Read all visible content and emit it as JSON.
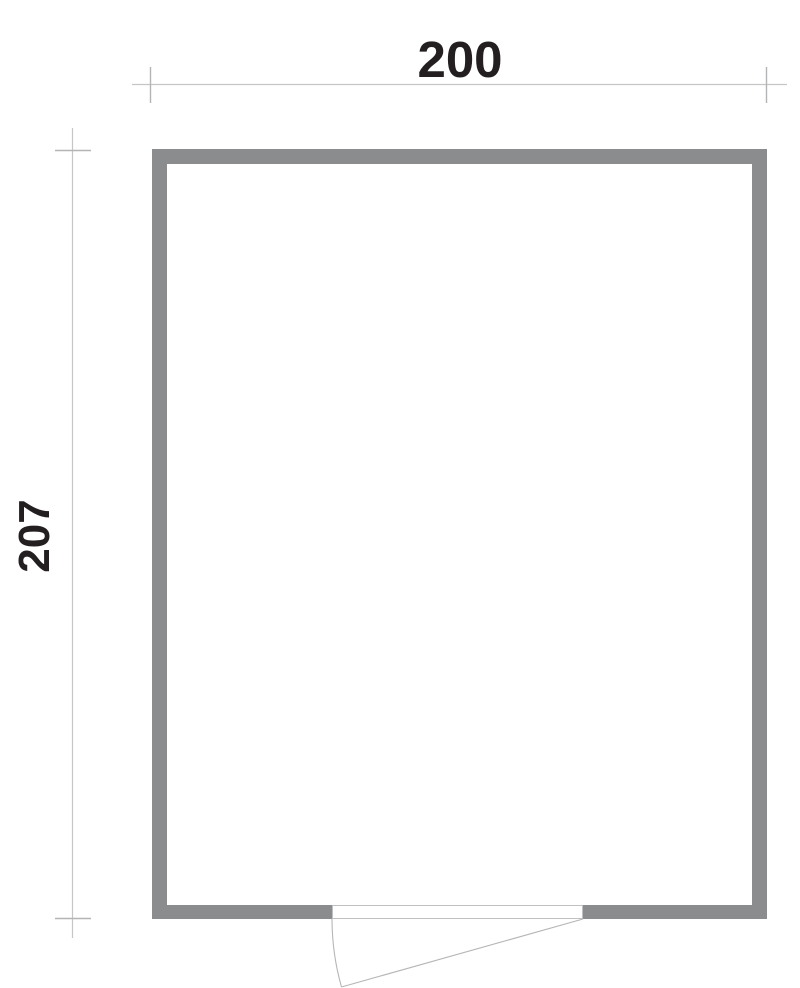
{
  "floor_plan": {
    "type": "room-outline-with-door",
    "width_dimension": {
      "label": "200"
    },
    "height_dimension": {
      "label": "207"
    }
  },
  "colors": {
    "background": "#ffffff",
    "wall_fill": "#8a8c8e",
    "dimension_line": "#c5c6c7",
    "dimension_tick": "#b3b4b5",
    "opening_edge_line": "#bfc0c1",
    "door_swing_line": "#b5b6b8",
    "label_text": "#231f20"
  }
}
